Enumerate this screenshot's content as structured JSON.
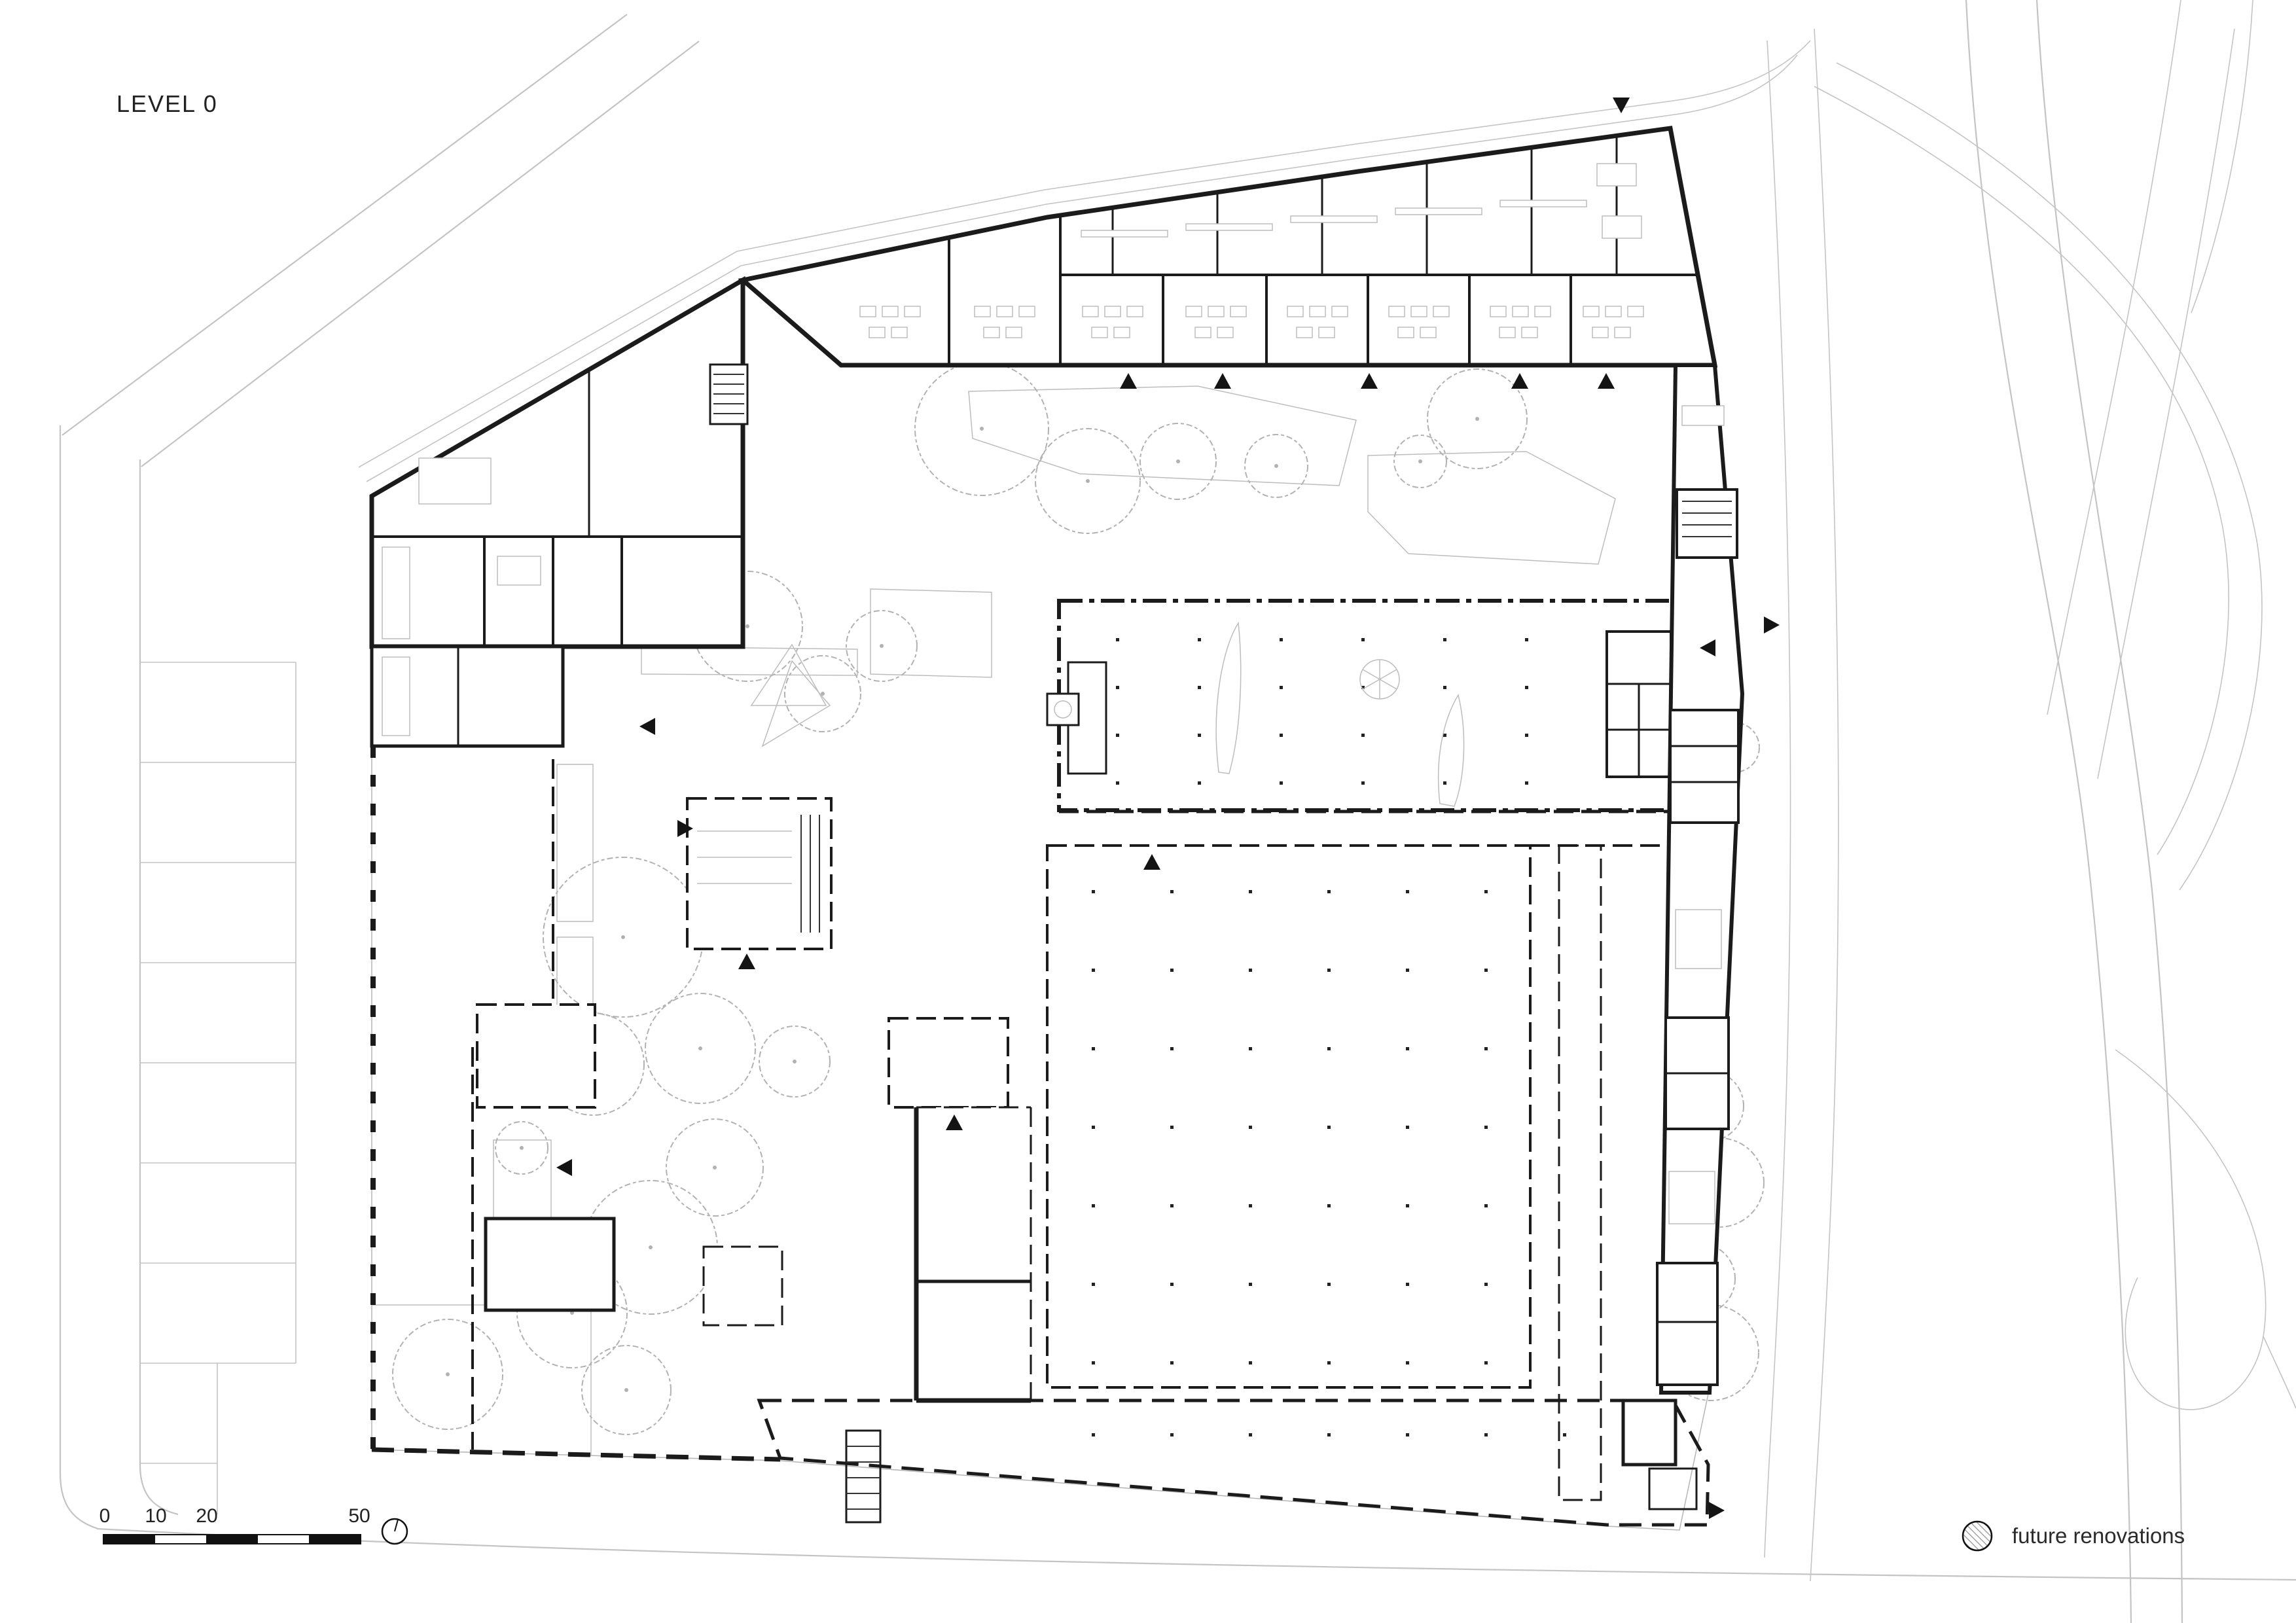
{
  "title": "LEVEL 0",
  "scale_bar": {
    "labels": [
      "0",
      "10",
      "20",
      "50"
    ]
  },
  "legend": {
    "items": [
      {
        "label": "future renovations",
        "swatch": "hatched-circle"
      }
    ]
  },
  "annotations": {
    "north_indicator": "compass-circle",
    "entrance_markers": "solid-black-triangles",
    "future_area_texture": "diagonal-hatch-on-gray"
  },
  "colors": {
    "wall": "#1b1b1b",
    "road": "#c4c4c4",
    "tree": "#b2b2b2",
    "paving_grid": "#e7e7e7",
    "hatch_fill": "#d2d2d2",
    "hatch_line": "#8f8f8f",
    "band_fill": "#dedede",
    "band_line": "#a5a5a5",
    "text": "#222222",
    "background": "#ffffff"
  }
}
